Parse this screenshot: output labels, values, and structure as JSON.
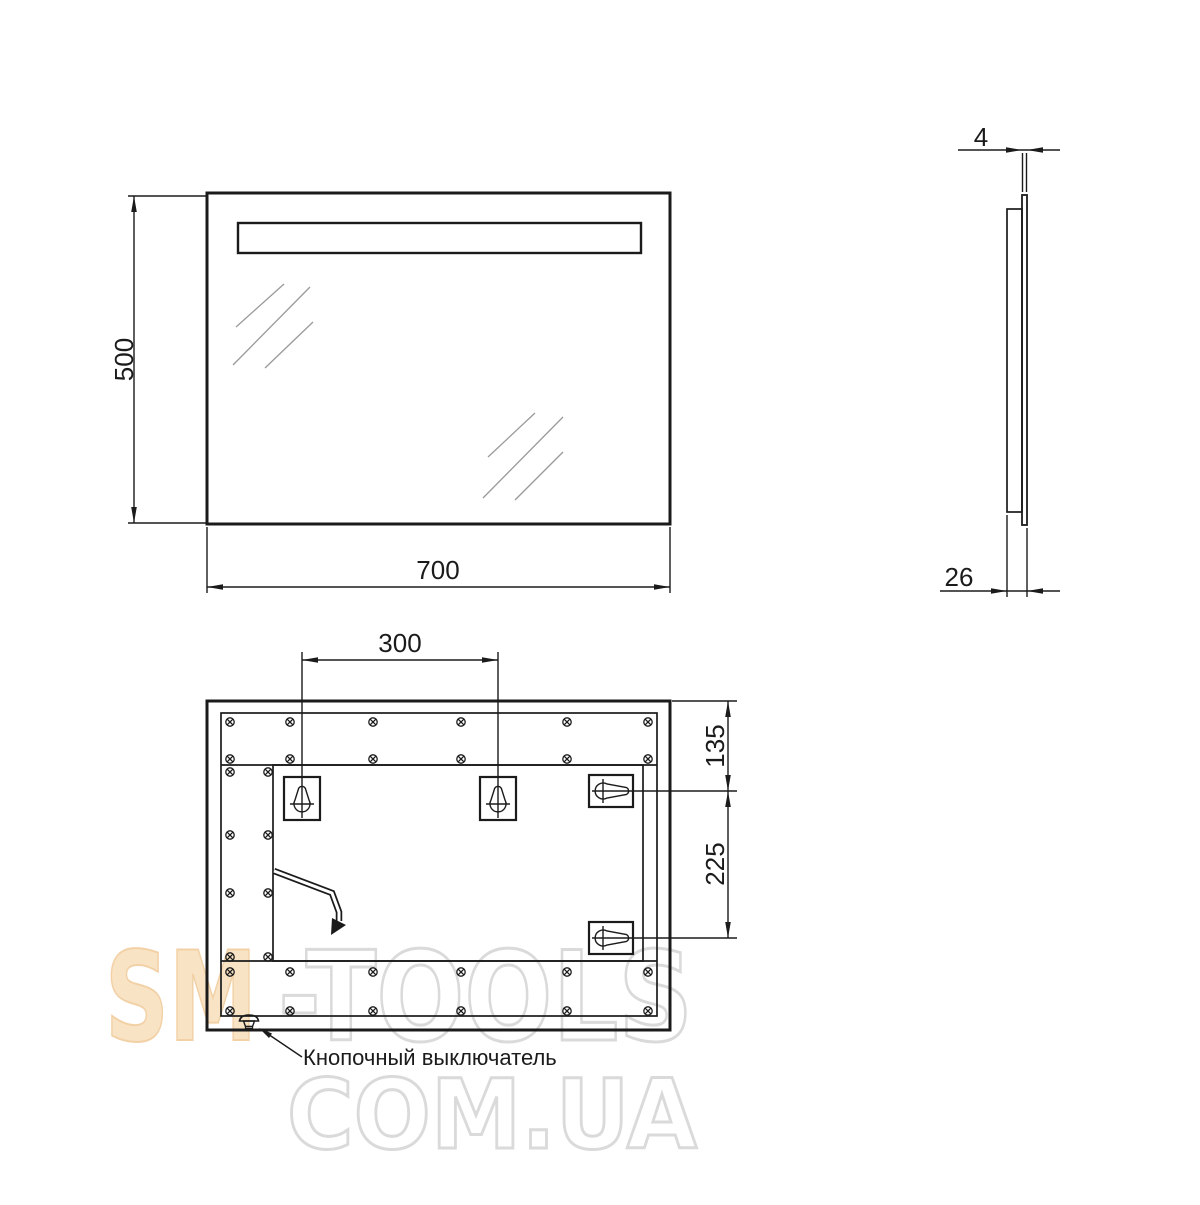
{
  "watermark": {
    "brand_accent": "SM",
    "brand_rest": "-TOOLS",
    "domain_line": "COM.UA",
    "accent_fill": "#f9e3c5",
    "accent_stroke": "#f2d1a6",
    "outline_color": "#dadada"
  },
  "views": {
    "front": {
      "width": "700",
      "height": "500"
    },
    "side": {
      "glass_thickness": "4",
      "depth": "26"
    },
    "back": {
      "bracket_spacing": "300",
      "top_offset": "135",
      "side_offset": "225",
      "switch_label": "Кнопочный выключатель"
    }
  },
  "colors": {
    "line": "#1b1b1b",
    "light_strip": "#c9c9c9"
  }
}
